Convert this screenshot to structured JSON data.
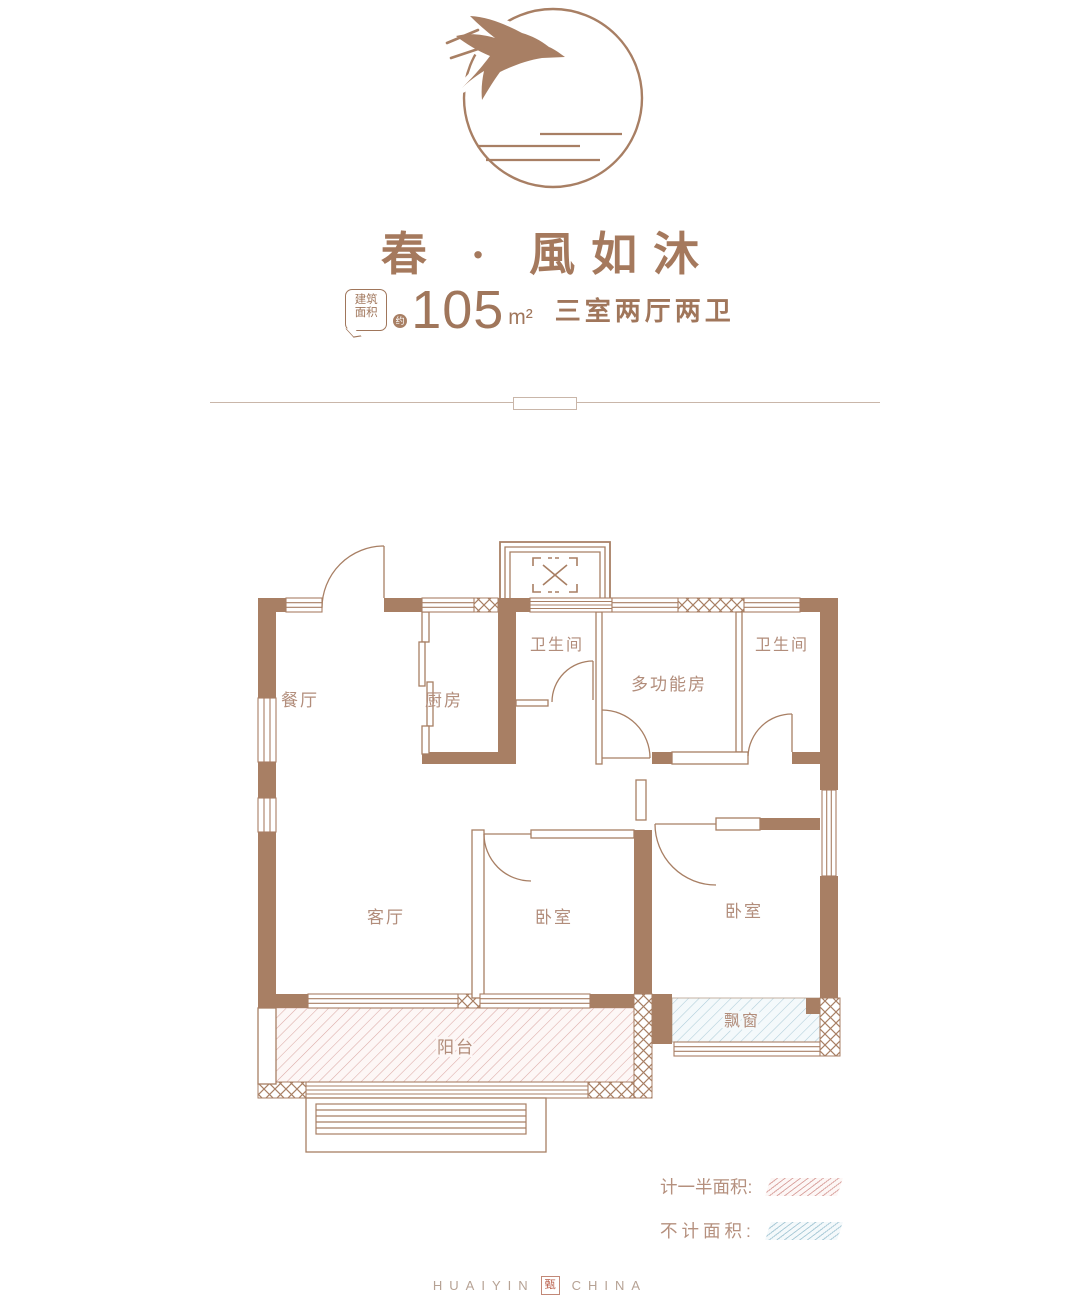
{
  "header": {
    "title": "春 · 風如沐",
    "badge_line1": "建筑",
    "badge_line2": "面积",
    "approx": "约",
    "area_value": "105",
    "area_unit": "m²",
    "layout_desc": "三室两厅两卫"
  },
  "floorplan": {
    "rooms": {
      "dining": "餐厅",
      "kitchen": "厨房",
      "bath1": "卫生间",
      "multi": "多功能房",
      "bath2": "卫生间",
      "living": "客厅",
      "bedroom1": "卧室",
      "bedroom2": "卧室",
      "balcony": "阳台",
      "baywindow": "飘窗"
    }
  },
  "legend": {
    "half": "计一半面积:",
    "none": "不计面积:"
  },
  "footer": {
    "left": "HUAIYIN",
    "seal": "甄",
    "right": "CHINA"
  },
  "colors": {
    "wall": "#a87f64",
    "pink_hatch": "#dcaaa6",
    "blue_hatch": "#aecdd9",
    "label_text": "#b28d7b"
  }
}
